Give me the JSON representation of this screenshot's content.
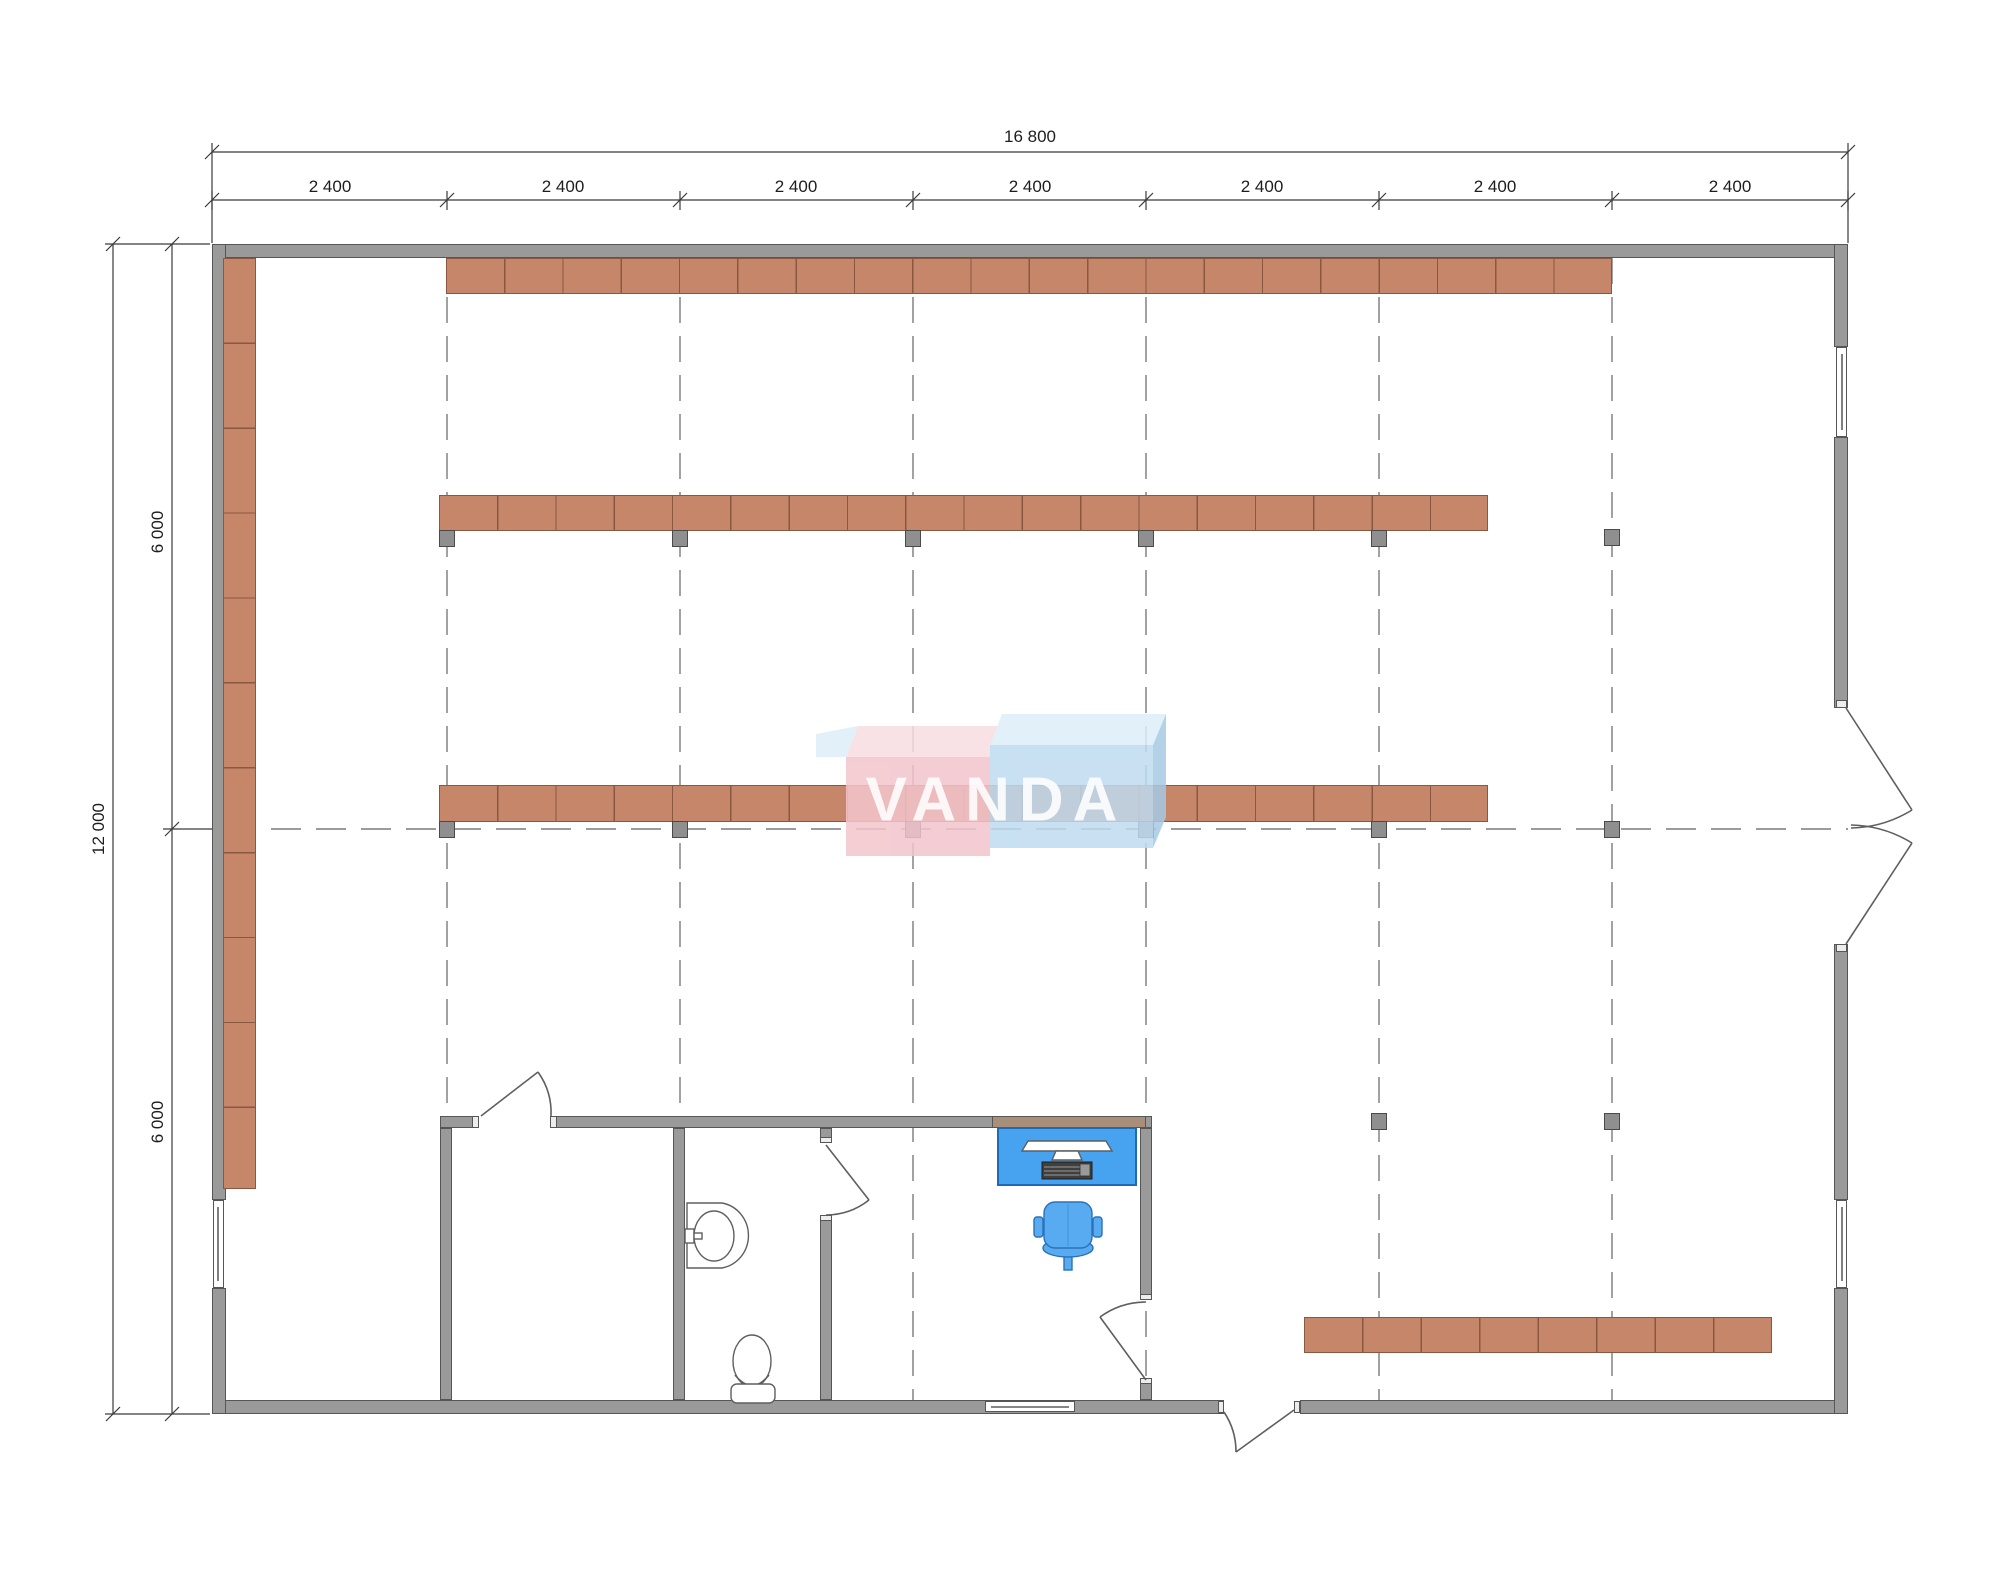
{
  "dimensions": {
    "top_total": "16 800",
    "top_segments": [
      "2 400",
      "2 400",
      "2 400",
      "2 400",
      "2 400",
      "2 400",
      "2 400"
    ],
    "left_total": "12 000",
    "left_segments": [
      "6 000",
      "6 000"
    ]
  },
  "logo": {
    "text": "VANDA"
  },
  "colors": {
    "wall": "#9a9a9a",
    "wall_edge": "#565656",
    "wall_tan": "#a98f79",
    "shelf": "#c6866a",
    "shelf_edge": "#8a5741",
    "column": "#8f8f8f",
    "column_edge": "#4a4a4a",
    "grid": "#7a7a7a",
    "dim": "#3a3a3a",
    "text": "#1d1d1d",
    "desk": "#47a2f0",
    "desk_edge": "#1f6ab4",
    "chair": "#58aaf1",
    "chair_edge": "#2a72b8",
    "fixture": "#5f5f5f",
    "logo_pink": "#f3c5cd",
    "logo_pink_top": "#f8dde2",
    "logo_blue": "#bedbf0",
    "logo_blue_top": "#ddeef8",
    "logo_blue_side": "#a6cbe5",
    "logo_text": "#ffffff"
  }
}
